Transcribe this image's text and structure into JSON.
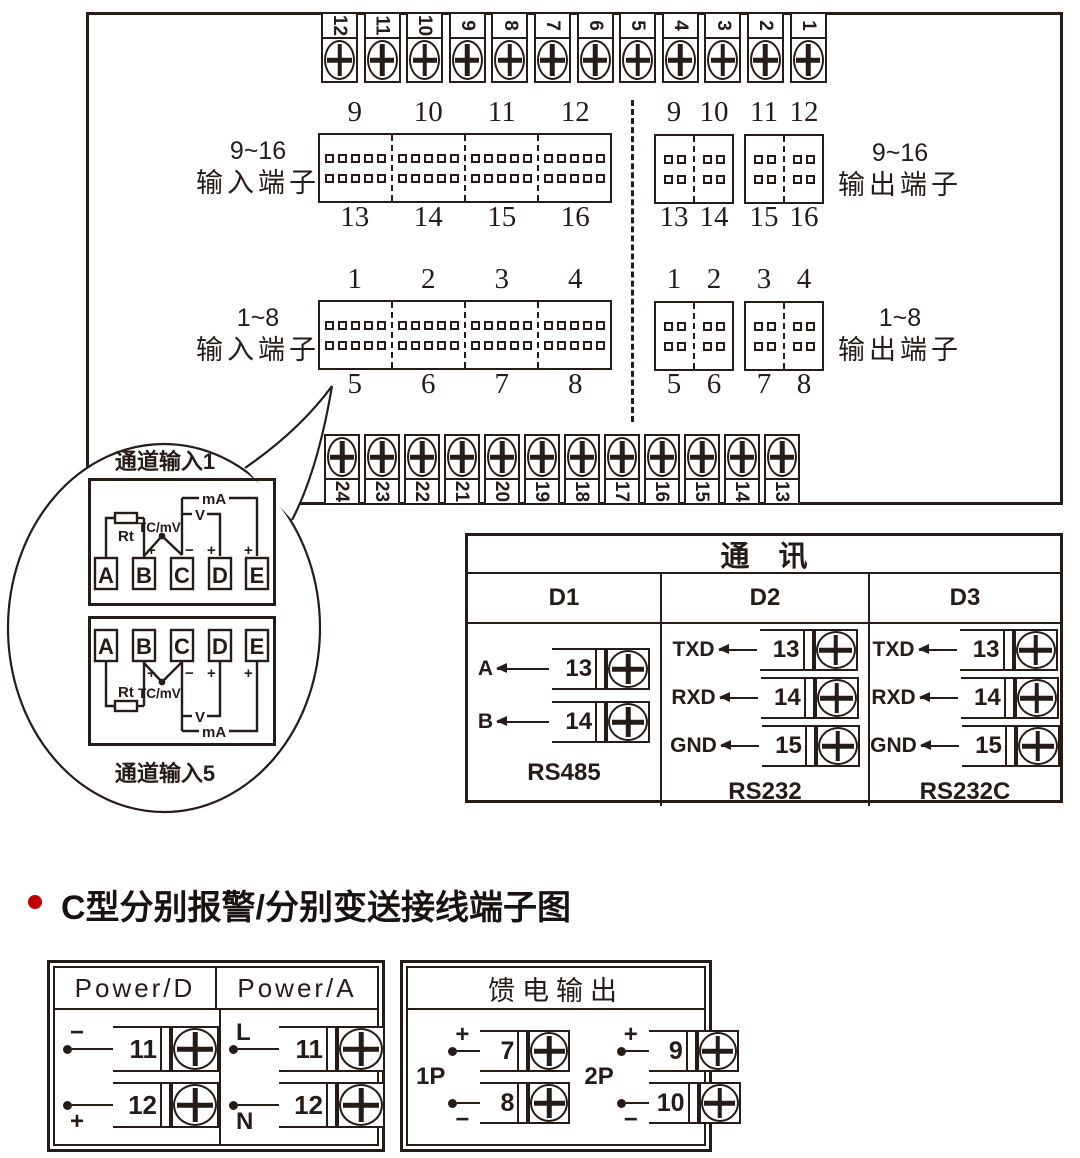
{
  "colors": {
    "ink": "#251c18",
    "bullet": "#c00000"
  },
  "top_terminal_row": {
    "numbers": [
      "12",
      "11",
      "10",
      "9",
      "8",
      "7",
      "6",
      "5",
      "4",
      "3",
      "2",
      "1"
    ]
  },
  "bottom_terminal_row": {
    "numbers": [
      "24",
      "23",
      "22",
      "21",
      "20",
      "19",
      "18",
      "17",
      "16",
      "15",
      "14",
      "13"
    ]
  },
  "terminal_blocks": {
    "input_9_16": {
      "side_label_line1": "9~16",
      "side_label_line2": "输入端子",
      "top_numbers": [
        "9",
        "10",
        "11",
        "12"
      ],
      "bottom_numbers": [
        "13",
        "14",
        "15",
        "16"
      ]
    },
    "output_9_16": {
      "side_label_line1": "9~16",
      "side_label_line2": "输出端子",
      "top_numbers": [
        "9",
        "10",
        "11",
        "12"
      ],
      "bottom_numbers": [
        "13",
        "14",
        "15",
        "16"
      ]
    },
    "input_1_8": {
      "side_label_line1": "1~8",
      "side_label_line2": "输入端子",
      "top_numbers": [
        "1",
        "2",
        "3",
        "4"
      ],
      "bottom_numbers": [
        "5",
        "6",
        "7",
        "8"
      ]
    },
    "output_1_8": {
      "side_label_line1": "1~8",
      "side_label_line2": "输出端子",
      "top_numbers": [
        "1",
        "2",
        "3",
        "4"
      ],
      "bottom_numbers": [
        "5",
        "6",
        "7",
        "8"
      ]
    }
  },
  "balloon": {
    "channel_top_label": "通道输入1",
    "channel_bottom_label": "通道输入5",
    "terminal_letters": [
      "A",
      "B",
      "C",
      "D",
      "E"
    ],
    "labels": {
      "rt": "Rt",
      "tc_mv": "TC/mV",
      "volt": "V",
      "milliamp": "mA",
      "plus": "+",
      "minus": "−"
    }
  },
  "comm_table": {
    "title": "通　讯",
    "columns": [
      {
        "name": "D1",
        "signals": [
          {
            "label": "A",
            "terminal": "13"
          },
          {
            "label": "B",
            "terminal": "14"
          }
        ],
        "standard": "RS485"
      },
      {
        "name": "D2",
        "signals": [
          {
            "label": "TXD",
            "terminal": "13"
          },
          {
            "label": "RXD",
            "terminal": "14"
          },
          {
            "label": "GND",
            "terminal": "15"
          }
        ],
        "standard": "RS232"
      },
      {
        "name": "D3",
        "signals": [
          {
            "label": "TXD",
            "terminal": "13"
          },
          {
            "label": "RXD",
            "terminal": "14"
          },
          {
            "label": "GND",
            "terminal": "15"
          }
        ],
        "standard": "RS232C"
      }
    ]
  },
  "section_heading": {
    "text": "C型分别报警/分别变送接线端子图"
  },
  "power_box": {
    "columns": [
      {
        "title": "Power/D",
        "rows": [
          {
            "sign": "−",
            "sign_position": "above",
            "terminal": "11"
          },
          {
            "sign": "+",
            "sign_position": "below",
            "terminal": "12"
          }
        ]
      },
      {
        "title": "Power/A",
        "rows": [
          {
            "sign": "L",
            "sign_position": "above",
            "terminal": "11"
          },
          {
            "sign": "N",
            "sign_position": "below",
            "terminal": "12"
          }
        ]
      }
    ]
  },
  "feed_output_box": {
    "title": "馈电输出",
    "groups": [
      {
        "label": "1P",
        "rows": [
          {
            "sign": "+",
            "sign_position": "above",
            "terminal": "7"
          },
          {
            "sign": "−",
            "sign_position": "below",
            "terminal": "8"
          }
        ]
      },
      {
        "label": "2P",
        "rows": [
          {
            "sign": "+",
            "sign_position": "above",
            "terminal": "9"
          },
          {
            "sign": "−",
            "sign_position": "below",
            "terminal": "10"
          }
        ]
      }
    ]
  }
}
